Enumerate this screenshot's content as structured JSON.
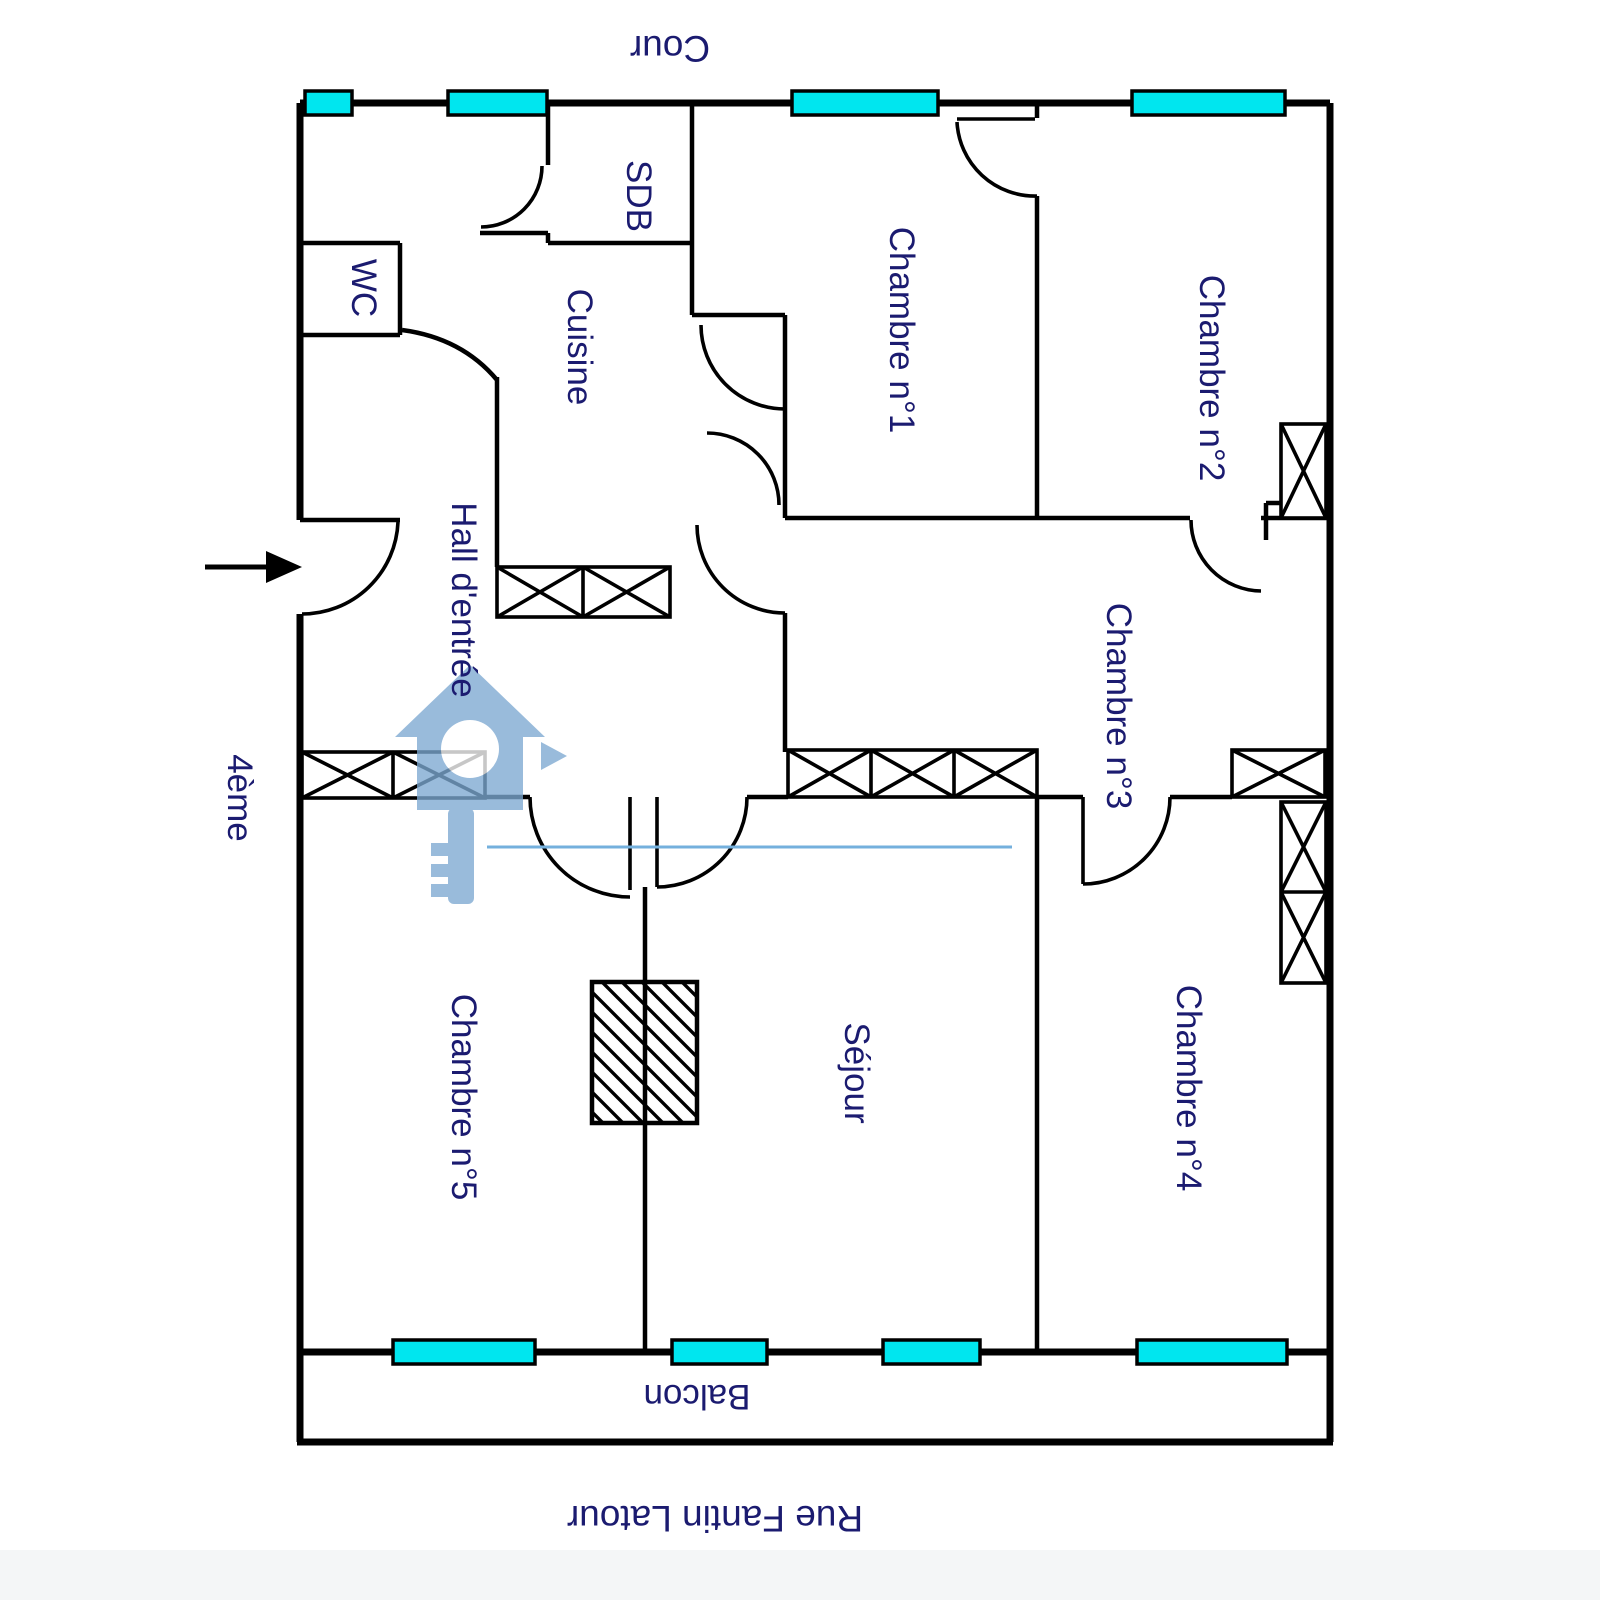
{
  "labels": {
    "cour": "Cour",
    "sdb": "SDB",
    "wc": "WC",
    "cuisine": "Cuisine",
    "hall_entree": "Hall d'entrée",
    "chambre1": "Chambre n°1",
    "chambre2": "Chambre n°2",
    "chambre3": "Chambre n°3",
    "chambre4": "Chambre n°4",
    "chambre5": "Chambre n°5",
    "sejour": "Séjour",
    "balcon": "Balcon",
    "etage": "4ème",
    "rue": "Rue Fantin Latour"
  },
  "colors": {
    "wall": "#000000",
    "window_fill": "#00e6ef",
    "label_text": "#1b1b70",
    "watermark_blue": "#7da9d2",
    "watermark_line": "#74b0dd",
    "background": "#ffffff"
  }
}
